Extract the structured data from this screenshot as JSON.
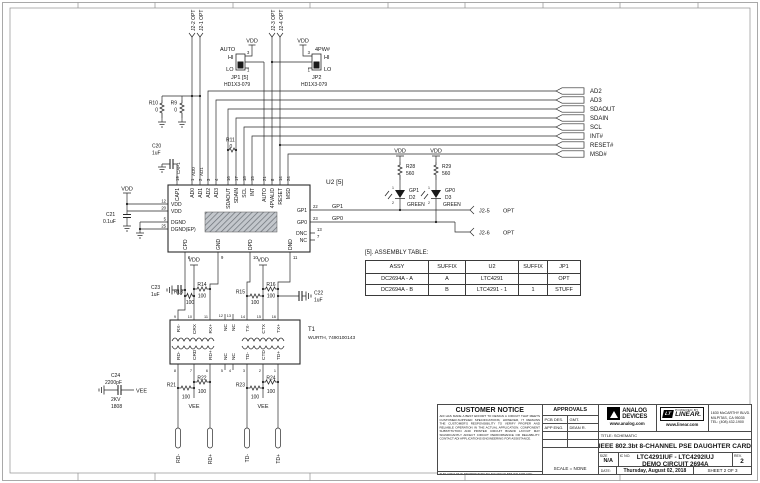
{
  "nets": {
    "vdd": "VDD",
    "vee": "VEE",
    "gp1": "GP1",
    "gp0": "GP0",
    "auto": "AUTO",
    "pw4": "4PW#",
    "cap1": "CAP1",
    "ad0": "AD0",
    "ad1": "AD1"
  },
  "conn_top": [
    "J2-2 OPT",
    "J2-1 OPT",
    "J2-3 OPT",
    "J2-4 OPT"
  ],
  "jp1": {
    "ref": "JP1 [5]",
    "part": "HD1X3-079",
    "hi": "HI",
    "lo": "LO",
    "p3": "3",
    "p1": "1"
  },
  "jp2": {
    "ref": "JP2",
    "part": "HD1X3-079",
    "hi": "HI",
    "lo": "LO",
    "p3": "3",
    "p1": "1"
  },
  "flags": [
    "AD2",
    "AD3",
    "SDAOUT",
    "SDAIN",
    "SCL",
    "INT#",
    "RESET#",
    "MSD#"
  ],
  "jflags": [
    {
      "n": "J2-5",
      "o": "OPT"
    },
    {
      "n": "J2-6",
      "o": "OPT"
    }
  ],
  "res": {
    "R9": [
      "R9",
      "0"
    ],
    "R10": [
      "R10",
      "0"
    ],
    "R11": [
      "R11",
      "0"
    ],
    "R13": [
      "R13",
      "100"
    ],
    "R14": [
      "R14",
      "100"
    ],
    "R15": [
      "R15",
      "100"
    ],
    "R16": [
      "R16",
      "100"
    ],
    "R21": [
      "R21",
      "100"
    ],
    "R22": [
      "R22",
      "100"
    ],
    "R23": [
      "R23",
      "100"
    ],
    "R24": [
      "R24",
      "100"
    ],
    "R28": [
      "R28",
      "560"
    ],
    "R29": [
      "R29",
      "560"
    ]
  },
  "cap": {
    "C20": [
      "C20",
      "1uF"
    ],
    "C21": [
      "C21",
      "0.1uF"
    ],
    "C22": [
      "C22",
      "1uF"
    ],
    "C23": [
      "C23",
      "1uF"
    ],
    "C24": [
      "C24",
      "2200pF",
      "2KV",
      "1808"
    ]
  },
  "led": {
    "d2": [
      "GP1",
      "D2",
      "GREEN",
      "1",
      "2"
    ],
    "d3": [
      "GP0",
      "D3",
      "GREEN",
      "1",
      "2"
    ]
  },
  "u2": {
    "ref": "U2 [5]",
    "top_names": [
      "CAP1",
      "AD0",
      "AD1",
      "AD2",
      "AD3",
      "SDAOUT",
      "SDAIN",
      "SCL",
      "INT",
      "AUTO",
      "4PVALID",
      "RESET",
      "MSD"
    ],
    "top_nums": [
      "19",
      "1",
      "2",
      "3",
      "4",
      "16",
      "17",
      "18",
      "15",
      "21",
      "8",
      "14",
      "24"
    ],
    "left_names": [
      "VDD",
      "VDD",
      "DGND",
      "DGND(EP)"
    ],
    "left_nums": [
      "12",
      "20",
      "5",
      "25"
    ],
    "right_names": [
      "GP1",
      "GP0",
      "DNC",
      "NC"
    ],
    "right_nums": [
      "22",
      "23",
      "13",
      "7"
    ],
    "bot_names": [
      "CPD",
      "GND",
      "DPD",
      "DND"
    ],
    "bot_nums": [
      "6",
      "9",
      "10",
      "11"
    ]
  },
  "t1": {
    "ref": "T1",
    "part": "WURTH, 7490100143",
    "top_names": [
      "RX-",
      "CRX",
      "RX+",
      "NC",
      "NC",
      "TX-",
      "CTX",
      "TX+"
    ],
    "top_nums": [
      "9",
      "10",
      "11",
      "12",
      "13",
      "14",
      "15",
      "16"
    ],
    "bot_names": [
      "RD-",
      "CRD",
      "RD+",
      "NC",
      "NC",
      "TD-",
      "CTD",
      "TD+"
    ],
    "bot_nums": [
      "8",
      "7",
      "6",
      "5",
      "4",
      "3",
      "2",
      "1"
    ]
  },
  "pads": [
    "RD-",
    "RD+",
    "TD-",
    "TD+"
  ],
  "assembly": {
    "title": "[5]. ASSEMBLY TABLE:",
    "headers": [
      "ASSY",
      "SUFFIX",
      "U2",
      "SUFFIX",
      "JP1"
    ],
    "rows": [
      [
        "DC2694A - A",
        "A",
        "LTC4291",
        "",
        "OPT"
      ],
      [
        "DC2694A - B",
        "B",
        "LTC4291 - 1",
        "1",
        "STUFF"
      ]
    ]
  },
  "tb": {
    "customer_notice": {
      "title": "CUSTOMER NOTICE",
      "body": "ADI HAS MADE A BEST EFFORT TO DESIGN A CIRCUIT THAT MEETS CUSTOMER-SUPPLIED SPECIFICATIONS; HOWEVER, IT REMAINS THE CUSTOMER'S RESPONSIBILITY TO VERIFY PROPER AND RELIABLE OPERATION IN THE ACTUAL APPLICATION. COMPONENT SUBSTITUTION AND PRINTED CIRCUIT BOARD LAYOUT MAY SIGNIFICANTLY AFFECT CIRCUIT PERFORMANCE OR RELIABILITY. CONTACT ADI APPLICATIONS ENGINEERING FOR ASSISTANCE.",
      "footer": "THIS CIRCUIT IS PROPRIETARY TO ADI AND SUPPLIED FOR USE WITH ADI PARTS."
    },
    "approvals": {
      "title": "APPROVALS",
      "rows": [
        {
          "l": "PCB DES.",
          "r": "GMT."
        },
        {
          "l": "APP ENG.",
          "r": "DEAN R."
        }
      ],
      "scale": "SCALE = NONE"
    },
    "brand": {
      "adi1": "ANALOG",
      "adi2": "DEVICES",
      "adi_url": "www.analog.com",
      "powered": "POWERED BY",
      "lt": "LT",
      "linear": "LINEAR.",
      "linear_url": "www.linear.com",
      "addr1": "1630 McCARTHY BLVD.",
      "addr2": "MILPITAS, CA 95035",
      "addr3": "TEL: (408) 432-1900"
    },
    "title_label": "TITLE: SCHEMATIC",
    "title": "IEEE 802.3bt 8-CHANNEL PSE DAUGHTER CARD",
    "size_label": "SIZE",
    "size": "N/A",
    "ic_label": "IC NO.",
    "part_line1": "LTC4291IUF - LTC4292IUJ",
    "part_line2": "DEMO CIRCUIT 2694A",
    "rev_label": "REV.",
    "rev": "2",
    "date_label": "DATE:",
    "date": "Thursday, August 02, 2018",
    "sheet": "SHEET 2 OF 3"
  }
}
